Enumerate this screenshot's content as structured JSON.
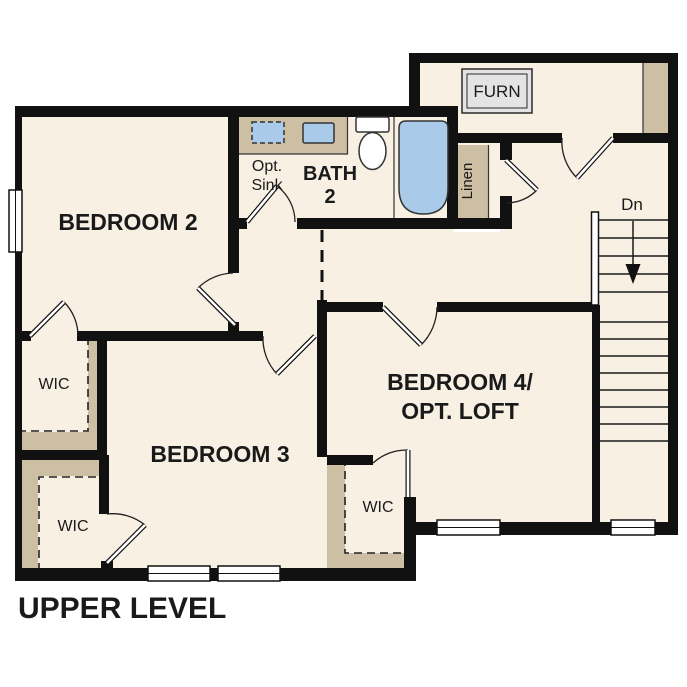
{
  "plan": {
    "title": "UPPER LEVEL",
    "rooms": {
      "bedroom2": "BEDROOM 2",
      "bedroom3": "BEDROOM 3",
      "bedroom4_line1": "BEDROOM 4/",
      "bedroom4_line2": "OPT. LOFT",
      "bath_line1": "BATH",
      "bath_line2": "2",
      "opt_sink_line1": "Opt.",
      "opt_sink_line2": "Sink",
      "wic": "WIC",
      "linen": "Linen",
      "furnace": "FURN",
      "stairs_direction": "Dn"
    },
    "colors": {
      "floor": "#f7f0e3",
      "closet_shading": "#cdbfa3",
      "fixture_blue": "#a9cae8",
      "wall": "#111111",
      "furnace_box": "#e4e4e4"
    }
  }
}
